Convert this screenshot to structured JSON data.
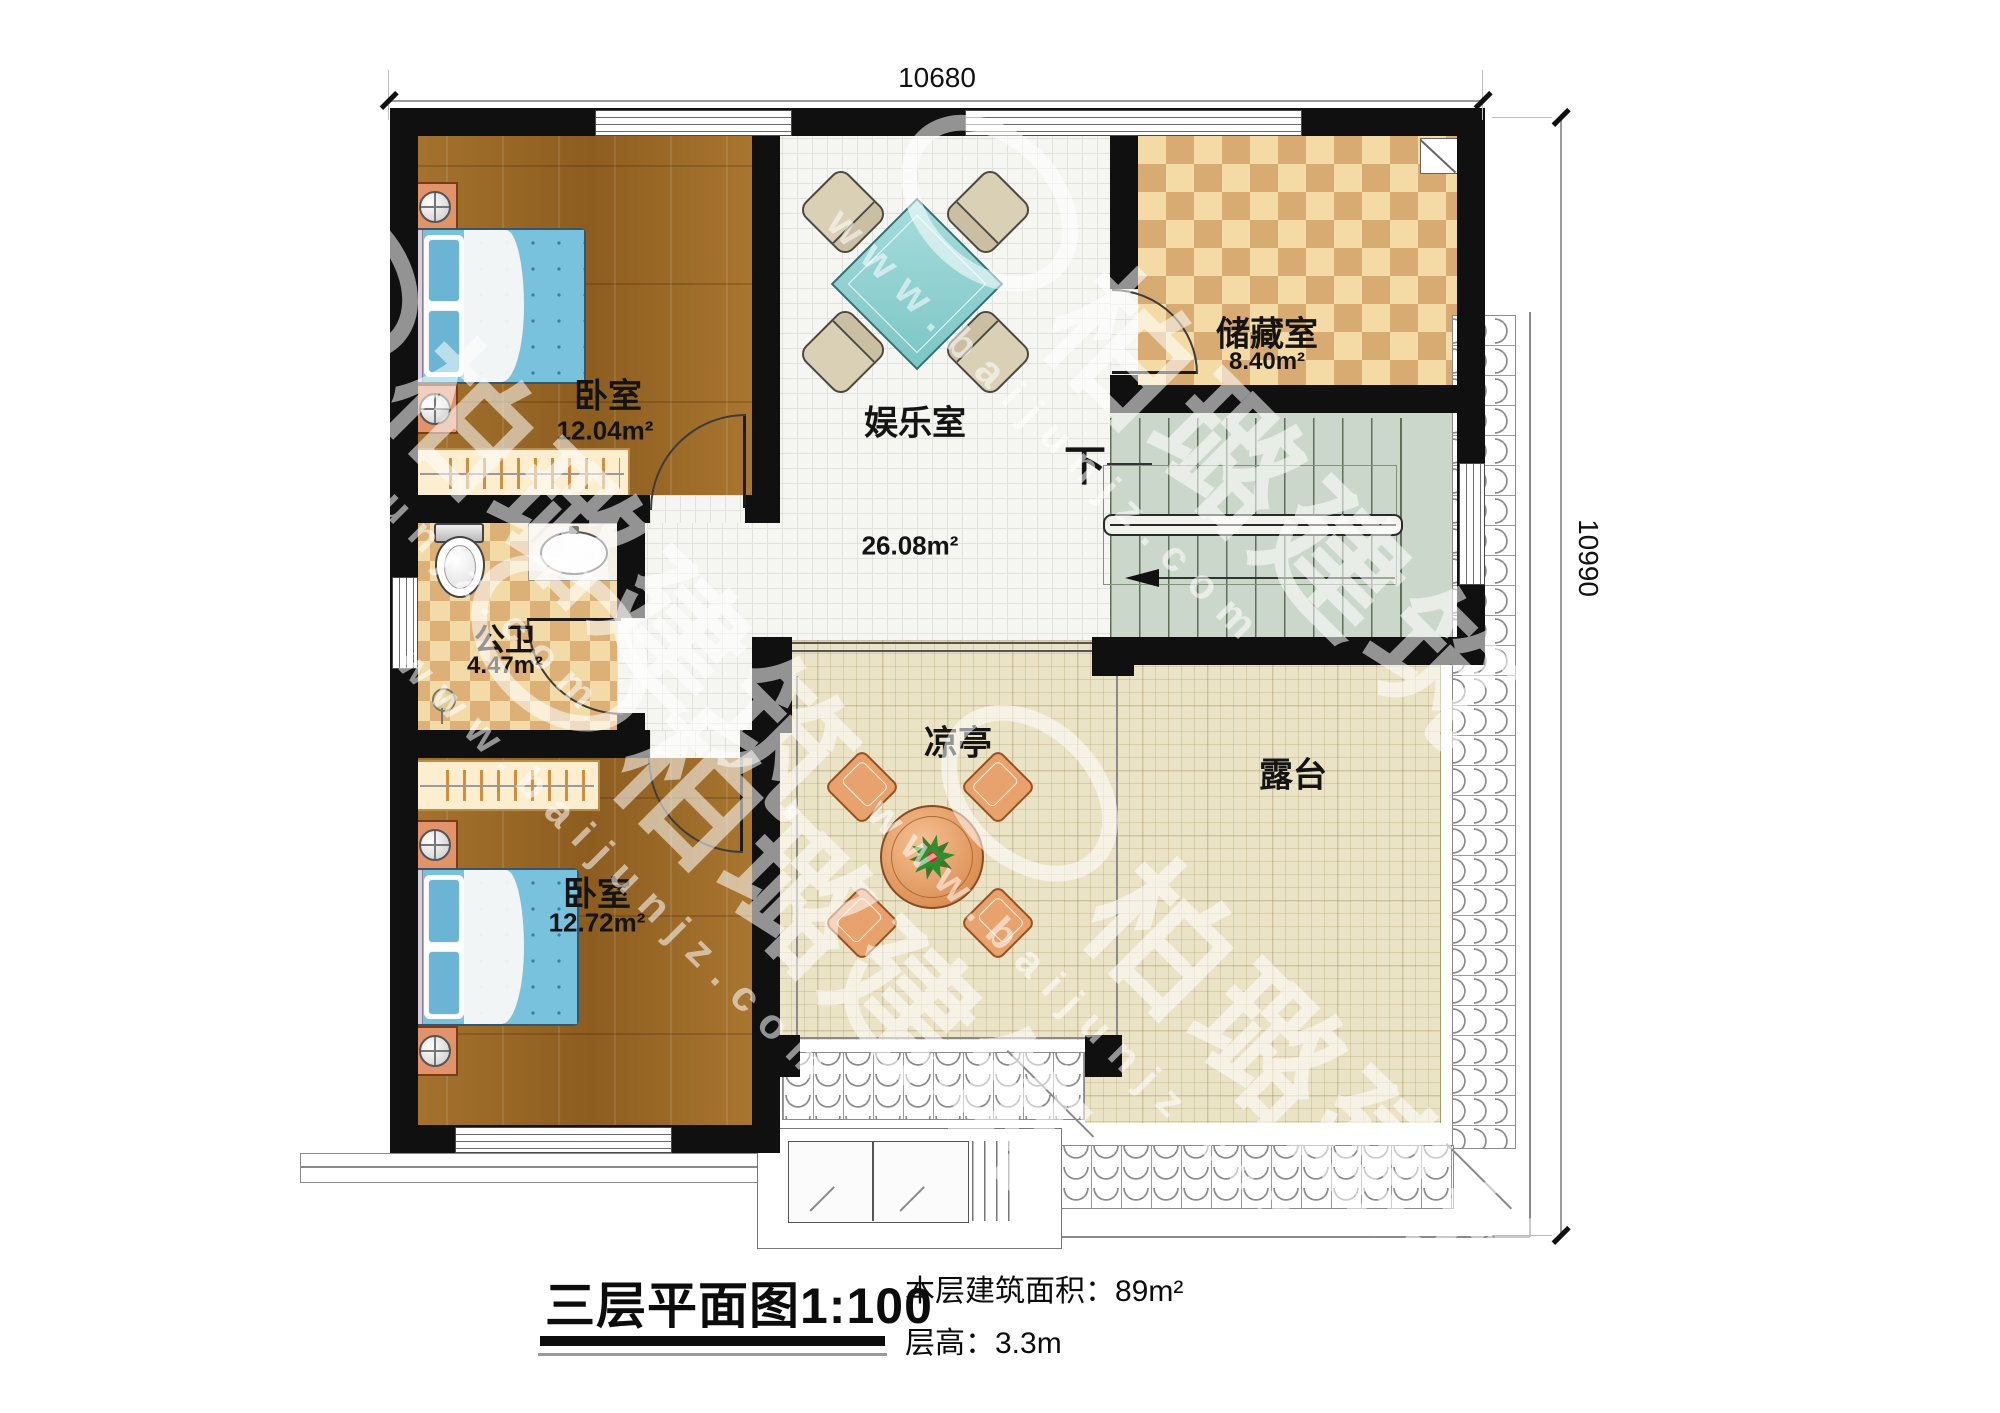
{
  "dimensions": {
    "width_label": "10680",
    "height_label": "10990"
  },
  "rooms": {
    "bedroom_top": {
      "name": "卧室",
      "area": "12.04m²"
    },
    "entertainment": {
      "name": "娱乐室",
      "area": "26.08m²"
    },
    "storage": {
      "name": "储藏室",
      "area": "8.40m²"
    },
    "bathroom": {
      "name": "公卫",
      "area": "4.47m²"
    },
    "bedroom_bottom": {
      "name": "卧室",
      "area": "12.72m²"
    },
    "pavilion": {
      "name": "凉亭"
    },
    "terrace": {
      "name": "露台"
    },
    "stairs": {
      "down_label": "下"
    }
  },
  "footer": {
    "title": "三层平面图",
    "scale": "1:100",
    "area_label": "本层建筑面积：",
    "area_value": "89m²",
    "floor_height_label": "层高：",
    "floor_height_value": "3.3m"
  },
  "watermark": {
    "brand": "柏璐建筑",
    "site": "www.baijunjz.com"
  },
  "colors": {
    "wall": "#101010",
    "wood_floor": "#9a6a2b",
    "white_tile": "#f5f5f2",
    "beige_tile": "#ebe3c6",
    "checker_tile": "#d8ab72",
    "stair_floor": "#ccd7cb",
    "bed_accent": "#79c2de",
    "table_accent": "#8fd0d0",
    "furniture_wood": "#e2936a"
  }
}
